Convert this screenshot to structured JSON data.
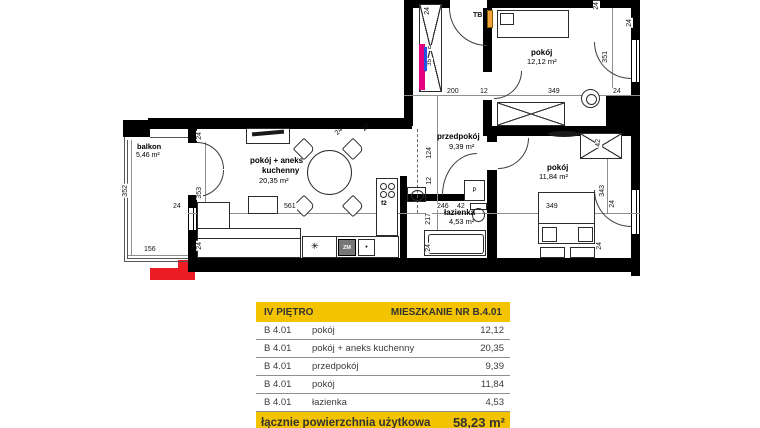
{
  "plan": {
    "rooms": {
      "balkon": {
        "name": "balkon",
        "area": "5,46 m²"
      },
      "living": {
        "name1": "pokój + aneks",
        "name2": "kuchenny",
        "area": "20,35 m²"
      },
      "przedpokoj": {
        "name": "przedpokój",
        "area": "9,39 m²"
      },
      "pokoj_top": {
        "name": "pokój",
        "area": "12,12 m²"
      },
      "pokoj_right": {
        "name": "pokój",
        "area": "11,84 m²"
      },
      "lazienka": {
        "name": "łazienka",
        "area": "4,53 m²"
      }
    },
    "markers": {
      "tb": "TB",
      "washer": "P",
      "dishwasher": "ZM",
      "stove": "f2",
      "fridge": "✳",
      "shaft_d": "d",
      "shaft_35": "35"
    },
    "dims": {
      "entry_24": "24",
      "top_200": "200",
      "top_12": "12",
      "top_349": "349",
      "top_24": "24",
      "right_24_a": "24",
      "right_351": "351",
      "right_24_b": "24",
      "diag_24_a": "24",
      "diag_24_b": "24",
      "hall_124": "124",
      "hall_12": "12",
      "bath_246": "246",
      "bath_42": "42",
      "bath_217": "217",
      "bath_24": "24",
      "room_349": "349",
      "room_343": "343",
      "room_24_a": "24",
      "room_24_b": "24",
      "wardrobe_42": "42",
      "living_561": "561",
      "living_24_left": "24",
      "living_353": "353",
      "living_24_top": "24",
      "living_24_bottom": "24",
      "balkon_352": "352",
      "balkon_156": "156"
    }
  },
  "table": {
    "header": {
      "left": "IV PIĘTRO",
      "right": "MIESZKANIE NR B.4.01"
    },
    "rows": [
      {
        "unit": "B 4.01",
        "room": "pokój",
        "area": "12,12"
      },
      {
        "unit": "B 4.01",
        "room": "pokój + aneks kuchenny",
        "area": "20,35"
      },
      {
        "unit": "B 4.01",
        "room": "przedpokój",
        "area": "9,39"
      },
      {
        "unit": "B 4.01",
        "room": "pokój",
        "area": "11,84"
      },
      {
        "unit": "B 4.01",
        "room": "łazienka",
        "area": "4,53"
      }
    ],
    "footer": {
      "label": "łącznie powierzchnia użytkowa",
      "value": "58,23 m²"
    }
  },
  "colors": {
    "accent_yellow": "#F3C300",
    "wall_black": "#000000",
    "shaft_magenta": "#E5007E",
    "shaft_blue": "#2255E0",
    "tb_orange": "#F2A33C",
    "marker_red": "#EC1C24"
  }
}
